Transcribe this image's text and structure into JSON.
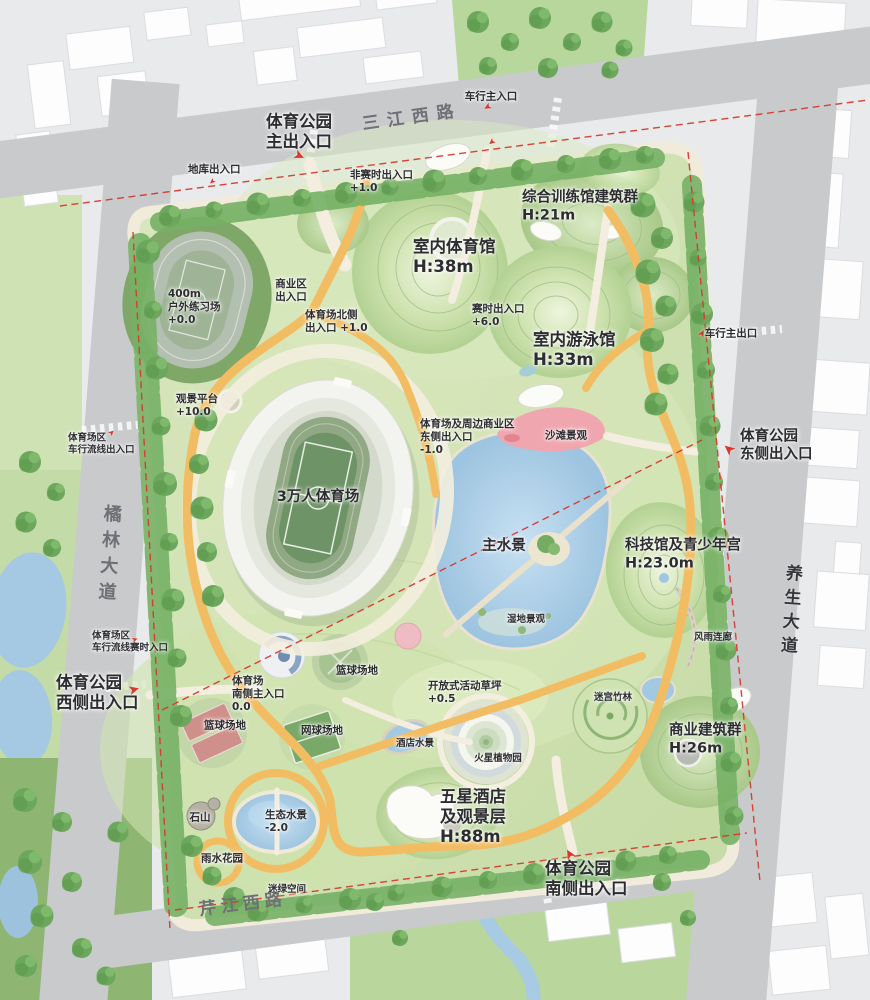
{
  "plan": {
    "park_name": "体育公园",
    "roads": {
      "north": "三江西路",
      "west": "橘林大道",
      "east": "养生大道",
      "south": "芹江西路"
    }
  },
  "colors": {
    "park_green": "#cfe2b2",
    "water_blue": "#a9cde6",
    "loop_path_yellow": "#f2bd62",
    "beach_pink": "#f0a6ae",
    "boundary_red": "#d63a2e",
    "road_gray": "#c9cacc",
    "building_white": "#fdfdfe",
    "tree_green": "#6ca75d",
    "arrow_red": "#d7372d"
  },
  "labels": [
    {
      "t": "车行主入口",
      "x": 491,
      "y": 97,
      "c": "sm"
    },
    {
      "t": "体育公园\n主出入口",
      "x": 299,
      "y": 132,
      "c": "xl"
    },
    {
      "t": "三江西路",
      "x": 412,
      "y": 118,
      "c": "road",
      "r": -8,
      "ls": 8
    },
    {
      "t": "地库出入口",
      "x": 188,
      "y": 170,
      "c": "sm",
      "a": "left"
    },
    {
      "t": "非赛时出入口\n+1.0",
      "x": 350,
      "y": 182,
      "c": "sm",
      "a": "left"
    },
    {
      "t": "综合训练馆建筑群\nH:21m",
      "x": 522,
      "y": 207,
      "c": "lg",
      "a": "left"
    },
    {
      "t": "室内体育馆\nH:38m",
      "x": 413,
      "y": 257,
      "c": "xl",
      "a": "left"
    },
    {
      "t": "商业区\n出入口",
      "x": 291,
      "y": 291,
      "c": "sm"
    },
    {
      "t": "400m\n户外练习场\n+0.0",
      "x": 168,
      "y": 307,
      "c": "sm",
      "a": "left"
    },
    {
      "t": "体育场北侧\n出入口 +1.0",
      "x": 305,
      "y": 322,
      "c": "sm",
      "a": "left"
    },
    {
      "t": "赛时出入口\n+6.0",
      "x": 472,
      "y": 316,
      "c": "sm",
      "a": "left"
    },
    {
      "t": "室内游泳馆\nH:33m",
      "x": 533,
      "y": 350,
      "c": "xl",
      "a": "left"
    },
    {
      "t": "车行主出口",
      "x": 731,
      "y": 334,
      "c": "sm"
    },
    {
      "t": "观景平台\n+10.0",
      "x": 176,
      "y": 406,
      "c": "sm",
      "a": "left"
    },
    {
      "t": "体育场区\n车行流线出入口",
      "x": 68,
      "y": 444,
      "c": "xs",
      "a": "left"
    },
    {
      "t": "体育公园\n东侧出入口",
      "x": 740,
      "y": 446,
      "c": "lg",
      "a": "left"
    },
    {
      "t": "体育场及周边商业区\n东侧出入口\n-1.0",
      "x": 420,
      "y": 437,
      "c": "sm",
      "a": "left"
    },
    {
      "t": "沙滩景观",
      "x": 566,
      "y": 436,
      "c": "sm"
    },
    {
      "t": "3万人体育场",
      "x": 318,
      "y": 498,
      "c": "lg"
    },
    {
      "t": "橘林大道",
      "x": 108,
      "y": 556,
      "c": "roadv",
      "r": 4
    },
    {
      "t": "主水景",
      "x": 504,
      "y": 547,
      "c": "lg"
    },
    {
      "t": "科技馆及青少年宫\nH:23.0m",
      "x": 625,
      "y": 555,
      "c": "lg",
      "a": "left"
    },
    {
      "t": "养生大道",
      "x": 789,
      "y": 612,
      "c": "roadv2",
      "r": 4
    },
    {
      "t": "湿地景观",
      "x": 526,
      "y": 620,
      "c": "xs"
    },
    {
      "t": "风雨连廊",
      "x": 713,
      "y": 638,
      "c": "xs"
    },
    {
      "t": "体育场区\n车行流线赛时入口",
      "x": 92,
      "y": 642,
      "c": "xs",
      "a": "left"
    },
    {
      "t": "体育公园\n西侧出入口",
      "x": 56,
      "y": 693,
      "c": "xl",
      "a": "left"
    },
    {
      "t": "篮球场地",
      "x": 357,
      "y": 671,
      "c": "sm"
    },
    {
      "t": "开放式活动草坪\n+0.5",
      "x": 428,
      "y": 693,
      "c": "sm",
      "a": "left"
    },
    {
      "t": "迷宫竹林",
      "x": 613,
      "y": 698,
      "c": "xs"
    },
    {
      "t": "体育场\n南侧主入口\n0.0",
      "x": 232,
      "y": 694,
      "c": "sm",
      "a": "left"
    },
    {
      "t": "篮球场地",
      "x": 225,
      "y": 726,
      "c": "sm"
    },
    {
      "t": "网球场地",
      "x": 322,
      "y": 731,
      "c": "sm"
    },
    {
      "t": "酒店水景",
      "x": 415,
      "y": 744,
      "c": "xs"
    },
    {
      "t": "商业建筑群\nH:26m",
      "x": 669,
      "y": 740,
      "c": "lg",
      "a": "left"
    },
    {
      "t": "火星植物园",
      "x": 498,
      "y": 759,
      "c": "xs"
    },
    {
      "t": "五星酒店\n及观景层\nH:88m",
      "x": 440,
      "y": 817,
      "c": "xl",
      "a": "left"
    },
    {
      "t": "生态水景\n-2.0",
      "x": 265,
      "y": 822,
      "c": "sm",
      "a": "left"
    },
    {
      "t": "石山",
      "x": 200,
      "y": 818,
      "c": "sm"
    },
    {
      "t": "雨水花园",
      "x": 222,
      "y": 859,
      "c": "sm"
    },
    {
      "t": "体育公园\n南侧出入口",
      "x": 545,
      "y": 879,
      "c": "xl",
      "a": "left"
    },
    {
      "t": "迷绿空间",
      "x": 287,
      "y": 890,
      "c": "xs"
    },
    {
      "t": "芹江西路",
      "x": 243,
      "y": 905,
      "c": "road",
      "r": -7,
      "ls": 5
    }
  ],
  "arrows": [
    {
      "x": 487,
      "y": 106,
      "r": 150,
      "s": 0.75
    },
    {
      "x": 491,
      "y": 141,
      "r": 140,
      "s": 0.7
    },
    {
      "x": 299,
      "y": 156,
      "r": 25,
      "s": 1.05
    },
    {
      "x": 212,
      "y": 181,
      "r": 140,
      "s": 0.6
    },
    {
      "x": 703,
      "y": 334,
      "r": -60,
      "s": 0.75
    },
    {
      "x": 729,
      "y": 449,
      "r": -140,
      "s": 1.15
    },
    {
      "x": 112,
      "y": 433,
      "r": -45,
      "s": 0.65
    },
    {
      "x": 135,
      "y": 640,
      "r": -20,
      "s": 0.65
    },
    {
      "x": 134,
      "y": 690,
      "r": -15,
      "s": 1.1
    },
    {
      "x": 570,
      "y": 854,
      "r": -120,
      "s": 1.1
    }
  ]
}
